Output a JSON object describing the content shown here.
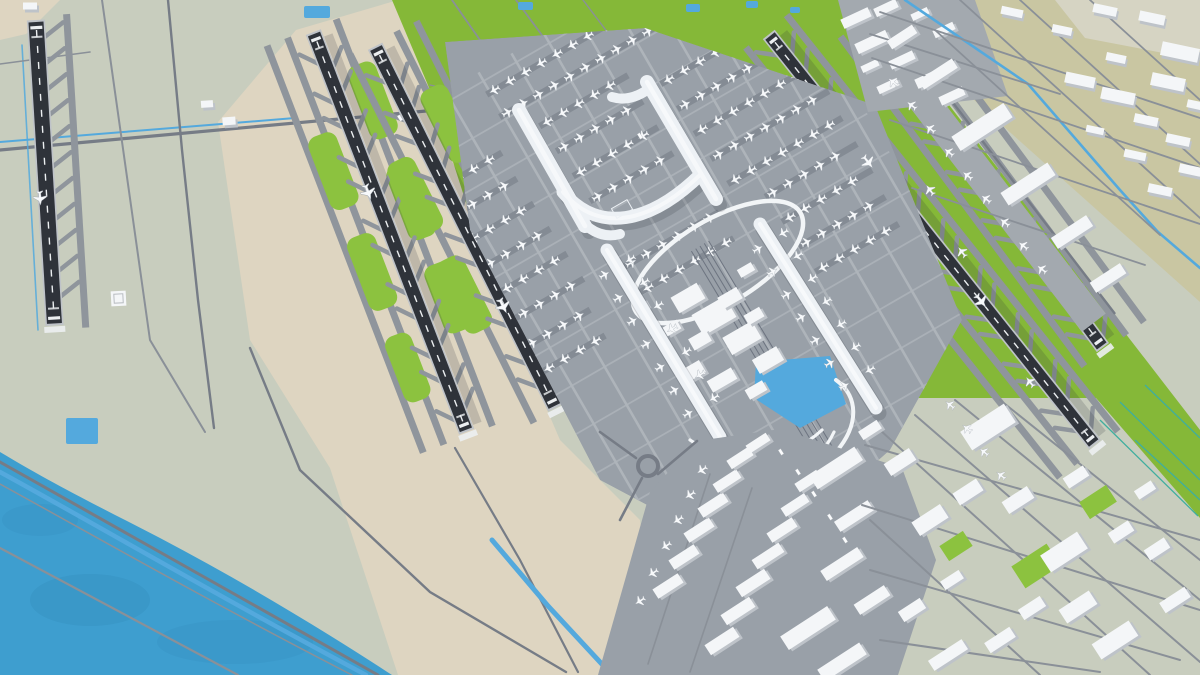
{
  "title": "Aerial 3D model of a large international airport: five dark runways, white H-shaped main terminal with two satellite piers, ground transport centre with loop roads and pond, cargo apron, coastal shoreline at lower left and khaki industrial districts to the right",
  "scene": {
    "view": "isometric aerial 3D render",
    "text_labels_visible": "none",
    "areas": {
      "water": "sea along the lower-left shoreline with coast road and canal",
      "left_runway": "single runway with parallel taxiway at far left",
      "center_runway_pair": "two parallel runways on beige midfield with green infield lenses",
      "east_runway_pair": "two parallel runways on bright green infield right of the terminal",
      "main_terminal": "white H-shaped terminal surrounded by aprons full of parked aircraft",
      "satellite_piers": "two long white linear concourses flanking the ground transport centre",
      "ground_transport_center": "white block buildings, elevated loop roads, rail lines and a pond",
      "cargo_area": "diagonal cargo apron with warehouse rows and freighter stands at bottom centre",
      "landside_green": "large green park with access roads at top centre",
      "cityside_industrial": "khaki district with flat white industrial buildings and a canal, top right",
      "support_district": "dense cluster of white buildings at bottom right",
      "small_ponds": "tiny blue ponds along the top edge and near the coast"
    }
  },
  "colors": {
    "sea": "#3E9ECF",
    "seaShade": "#3692C2",
    "sage": "#C8CDBE",
    "beige": "#DED5C1",
    "khaki": "#C9C6A2",
    "paleSlab": "#D6D4C3",
    "grass": "#85B838",
    "grassBright": "#8CC23F",
    "taxiway": "#8F959C",
    "apronLight": "#A3A9AF",
    "lane": "#AEB4BA",
    "apron": "#99A0A8",
    "standRow": "#848B94",
    "runway": "#2F333A",
    "runwayEdge": "#BFC3C8",
    "runwayMark": "#ECEFF1",
    "road": "#767C86",
    "roadThin": "#8A9098",
    "canal": "#54A9DD",
    "drainage": "#3FAE9F",
    "ramp": "#F2F5F7",
    "buildingTop": "#F4F6F8",
    "buildingSide": "#BEC3C9",
    "terminal": "#EDF1F5",
    "plane": "#F7F9FB",
    "planeStroke": "#9AA1A9",
    "shadow": "rgba(45,52,62,0.18)"
  },
  "icons": [
    {
      "name": "aircraft-icon",
      "meaning": "parked or taxiing airplane, top view"
    }
  ]
}
